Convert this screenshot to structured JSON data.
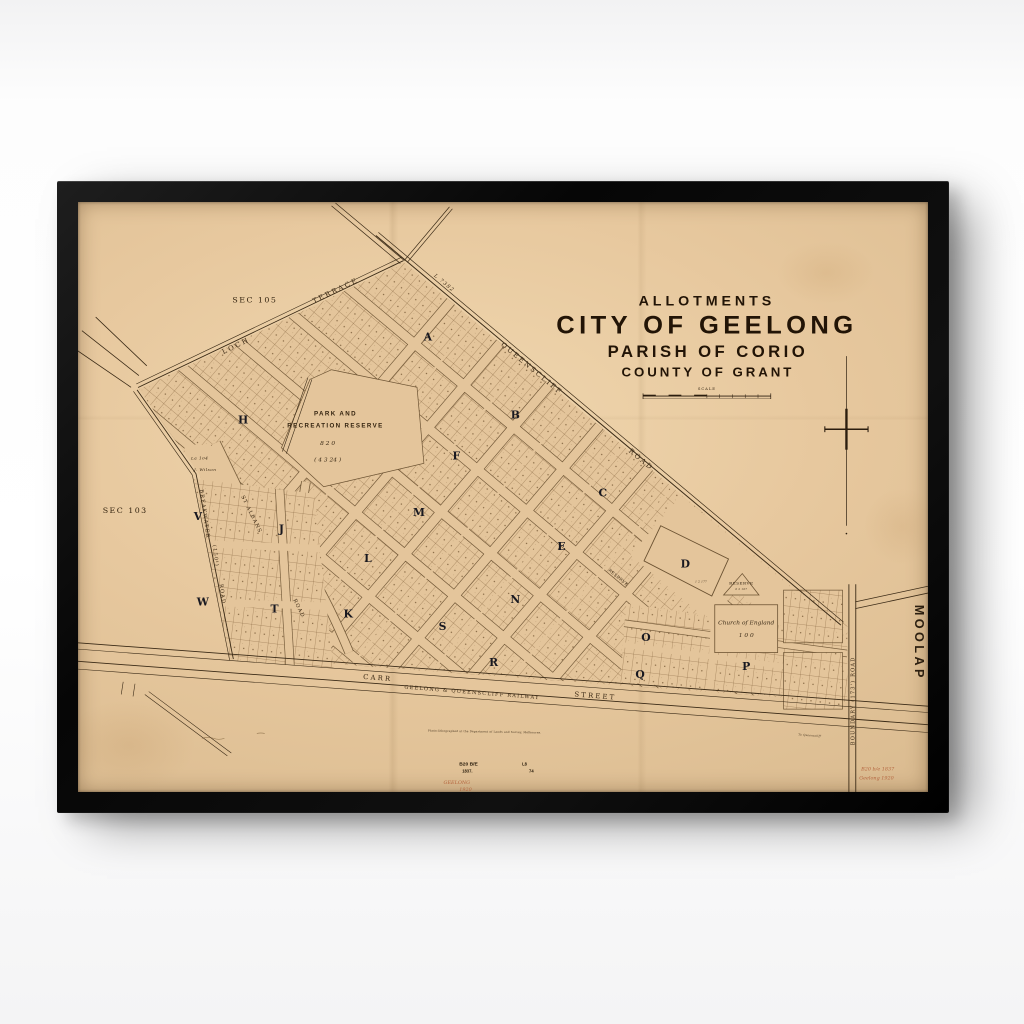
{
  "artwork": {
    "type": "framed vintage allotment map poster",
    "frame_color": "#0b0b0b",
    "wall_color": "#ffffff",
    "paper_color": "#e4c59b",
    "ink_color": "#3a2a16",
    "lot_line_color": "#7a5a34",
    "block_letter_color": "#181820",
    "red_note_color": "#b4653e",
    "title_block": {
      "line1": "ALLOTMENTS",
      "line2": "CITY OF GEELONG",
      "line3": "PARISH OF CORIO",
      "line4": "COUNTY OF GRANT",
      "scale_label": "SCALE"
    }
  },
  "map": {
    "labels": [
      {
        "name": "title-allotments",
        "text": "ALLOTMENTS",
        "x": 640,
        "y": 106,
        "a": "m",
        "cls": "t1"
      },
      {
        "name": "title-city-of-geelong",
        "text": "CITY OF GEELONG",
        "x": 640,
        "y": 135,
        "a": "m",
        "cls": "t2"
      },
      {
        "name": "title-parish-of-corio",
        "text": "PARISH OF CORIO",
        "x": 641,
        "y": 159,
        "a": "m",
        "cls": "t3"
      },
      {
        "name": "title-county-of-grant",
        "text": "COUNTY OF GRANT",
        "x": 641,
        "y": 179,
        "a": "m",
        "cls": "t4"
      },
      {
        "name": "scale-label",
        "text": "SCALE",
        "x": 640,
        "y": 193,
        "a": "m",
        "cls": "scale-t"
      },
      {
        "name": "sec-105",
        "text": "SEC 105",
        "x": 180,
        "y": 103,
        "a": "m",
        "cls": "sec"
      },
      {
        "name": "sec-103",
        "text": "SEC 103",
        "x": 48,
        "y": 319,
        "a": "m",
        "cls": "sec"
      },
      {
        "name": "street-loch",
        "text": "LOCH",
        "x": 148,
        "y": 156,
        "r": -26,
        "cls": "street"
      },
      {
        "name": "street-terrace",
        "text": "TERRACE",
        "x": 240,
        "y": 104,
        "r": -26,
        "cls": "street"
      },
      {
        "name": "street-queenscliff",
        "text": "QUEENSCLIFF",
        "x": 430,
        "y": 147,
        "r": 40,
        "cls": "street"
      },
      {
        "name": "street-queenscliff-road",
        "text": "ROAD",
        "x": 560,
        "y": 256,
        "r": 40,
        "cls": "street"
      },
      {
        "name": "label-l7382",
        "text": "L 7382",
        "x": 362,
        "y": 76,
        "r": 40,
        "cls": "street-sm it"
      },
      {
        "name": "street-breakwater",
        "text": "BREAKWATER",
        "x": 124,
        "y": 295,
        "r": 82,
        "cls": "street-sm"
      },
      {
        "name": "street-breakwater-width",
        "text": "(150')",
        "x": 137,
        "y": 352,
        "r": 82,
        "cls": "street-sm"
      },
      {
        "name": "street-breakwater-road",
        "text": "ROAD",
        "x": 144,
        "y": 392,
        "r": 82,
        "cls": "street-sm"
      },
      {
        "name": "street-st-albans",
        "text": "ST ALBANS",
        "x": 166,
        "y": 302,
        "r": 64,
        "cls": "street-sm"
      },
      {
        "name": "street-st-albans-road",
        "text": "ROAD",
        "x": 219,
        "y": 408,
        "r": 64,
        "cls": "street-sm"
      },
      {
        "name": "street-carr",
        "text": "CARR",
        "x": 290,
        "y": 489,
        "r": 4.5,
        "cls": "street"
      },
      {
        "name": "street-carr-street",
        "text": "STREET",
        "x": 505,
        "y": 507,
        "r": 4.5,
        "cls": "street"
      },
      {
        "name": "railway-label",
        "text": "GEELONG & QUEENSCLIFF RAILWAY",
        "x": 332,
        "y": 499,
        "r": 4.5,
        "cls": "street-sm"
      },
      {
        "name": "street-boundary-road",
        "text": "BOUNDARY    (173')    ROAD",
        "x": 790,
        "y": 557,
        "r": -90,
        "cls": "street-sm"
      },
      {
        "name": "locality-moolap",
        "text": "MOOLAP",
        "x": 852,
        "y": 413,
        "r": 90,
        "cls": "moolap"
      },
      {
        "name": "block-a",
        "text": "A",
        "x": 356,
        "y": 142,
        "a": "m",
        "cls": "block"
      },
      {
        "name": "block-b",
        "text": "B",
        "x": 445,
        "y": 222,
        "a": "m",
        "cls": "block"
      },
      {
        "name": "block-c",
        "text": "C",
        "x": 534,
        "y": 302,
        "a": "m",
        "cls": "block"
      },
      {
        "name": "block-d",
        "text": "D",
        "x": 618,
        "y": 375,
        "a": "m",
        "cls": "block"
      },
      {
        "name": "block-e",
        "text": "E",
        "x": 492,
        "y": 357,
        "a": "m",
        "cls": "block"
      },
      {
        "name": "block-f",
        "text": "F",
        "x": 385,
        "y": 264,
        "a": "m",
        "cls": "block"
      },
      {
        "name": "block-h",
        "text": "H",
        "x": 168,
        "y": 227,
        "a": "m",
        "cls": "block"
      },
      {
        "name": "block-j",
        "text": "J",
        "x": 207,
        "y": 339,
        "a": "m",
        "cls": "block"
      },
      {
        "name": "block-k",
        "text": "K",
        "x": 275,
        "y": 426,
        "a": "m",
        "cls": "block"
      },
      {
        "name": "block-l",
        "text": "L",
        "x": 295,
        "y": 369,
        "a": "m",
        "cls": "block"
      },
      {
        "name": "block-m",
        "text": "M",
        "x": 347,
        "y": 322,
        "a": "m",
        "cls": "block"
      },
      {
        "name": "block-n",
        "text": "N",
        "x": 445,
        "y": 411,
        "a": "m",
        "cls": "block"
      },
      {
        "name": "block-o",
        "text": "O",
        "x": 578,
        "y": 450,
        "a": "m",
        "cls": "block"
      },
      {
        "name": "block-p",
        "text": "P",
        "x": 680,
        "y": 480,
        "a": "m",
        "cls": "block"
      },
      {
        "name": "block-q",
        "text": "Q",
        "x": 572,
        "y": 488,
        "a": "m",
        "cls": "block"
      },
      {
        "name": "block-r",
        "text": "R",
        "x": 423,
        "y": 476,
        "a": "m",
        "cls": "block"
      },
      {
        "name": "block-s",
        "text": "S",
        "x": 371,
        "y": 439,
        "a": "m",
        "cls": "block"
      },
      {
        "name": "block-t",
        "text": "T",
        "x": 200,
        "y": 421,
        "a": "m",
        "cls": "block"
      },
      {
        "name": "block-v",
        "text": "V",
        "x": 122,
        "y": 326,
        "a": "m",
        "cls": "block"
      },
      {
        "name": "block-w",
        "text": "W",
        "x": 127,
        "y": 414,
        "a": "m",
        "cls": "block"
      },
      {
        "name": "park-reserve-line1",
        "text": "PARK AND",
        "x": 262,
        "y": 219,
        "a": "m",
        "cls": "place"
      },
      {
        "name": "park-reserve-line2",
        "text": "RECREATION RESERVE",
        "x": 262,
        "y": 231,
        "a": "m",
        "cls": "place"
      },
      {
        "name": "park-reserve-area1",
        "text": "8   2   0",
        "x": 254,
        "y": 249,
        "a": "m",
        "cls": "place-it"
      },
      {
        "name": "park-reserve-area2",
        "text": "( 4   3   24 )",
        "x": 254,
        "y": 266,
        "a": "m",
        "cls": "place-it"
      },
      {
        "name": "reserve-triangle",
        "text": "RESERVE",
        "x": 675,
        "y": 392,
        "a": "m",
        "cls": "tiny"
      },
      {
        "name": "reserve-triangle-area",
        "text": "0  2  107",
        "x": 675,
        "y": 398,
        "a": "m",
        "cls": "fine it"
      },
      {
        "name": "reserve-small",
        "text": "RESERVE",
        "x": 549,
        "y": 386,
        "r": 40,
        "a": "m",
        "cls": "tiny"
      },
      {
        "name": "church-of-england",
        "text": "Church  of  England",
        "x": 680,
        "y": 433,
        "a": "m",
        "cls": "place-it"
      },
      {
        "name": "church-area",
        "text": "1  0  0",
        "x": 680,
        "y": 446,
        "a": "m",
        "cls": "place-it"
      },
      {
        "name": "lot-la104",
        "text": "La 104",
        "x": 115,
        "y": 264,
        "cls": "tiny it"
      },
      {
        "name": "lot-j-wilson",
        "text": "J. Wilson",
        "x": 118,
        "y": 276,
        "cls": "tiny it"
      },
      {
        "name": "d-block-area",
        "text": "1  2  177",
        "x": 628,
        "y": 390,
        "cls": "fine it"
      },
      {
        "name": "fine-print",
        "text": "Photo-lithographed at the Department of Lands and Survey, Melbourne.",
        "x": 356,
        "y": 543,
        "r": 1,
        "cls": "fine"
      },
      {
        "name": "to-queenscliff",
        "text": "To Queenscliff",
        "x": 733,
        "y": 547,
        "r": 4,
        "cls": "fine it"
      },
      {
        "name": "stamp-plan-number",
        "text": "B20 B/E",
        "x": 388,
        "y": 578,
        "cls": "stamp"
      },
      {
        "name": "stamp-year",
        "text": "1837.",
        "x": 391,
        "y": 585,
        "cls": "stamp stamp-sm"
      },
      {
        "name": "stamp-l8",
        "text": "L8",
        "x": 452,
        "y": 578,
        "cls": "stamp stamp-sm"
      },
      {
        "name": "stamp-74",
        "text": "74",
        "x": 459,
        "y": 585,
        "cls": "stamp stamp-sm"
      },
      {
        "name": "red-note-geelong",
        "text": "GEELONG",
        "x": 372,
        "y": 597,
        "cls": "red"
      },
      {
        "name": "red-note-year",
        "text": "1920",
        "x": 388,
        "y": 604,
        "cls": "red"
      },
      {
        "name": "red-note-right1",
        "text": "B20 b/e 1837",
        "x": 797,
        "y": 583,
        "cls": "red"
      },
      {
        "name": "red-note-right2",
        "text": "Geelong 1920",
        "x": 795,
        "y": 592,
        "cls": "red"
      }
    ]
  }
}
